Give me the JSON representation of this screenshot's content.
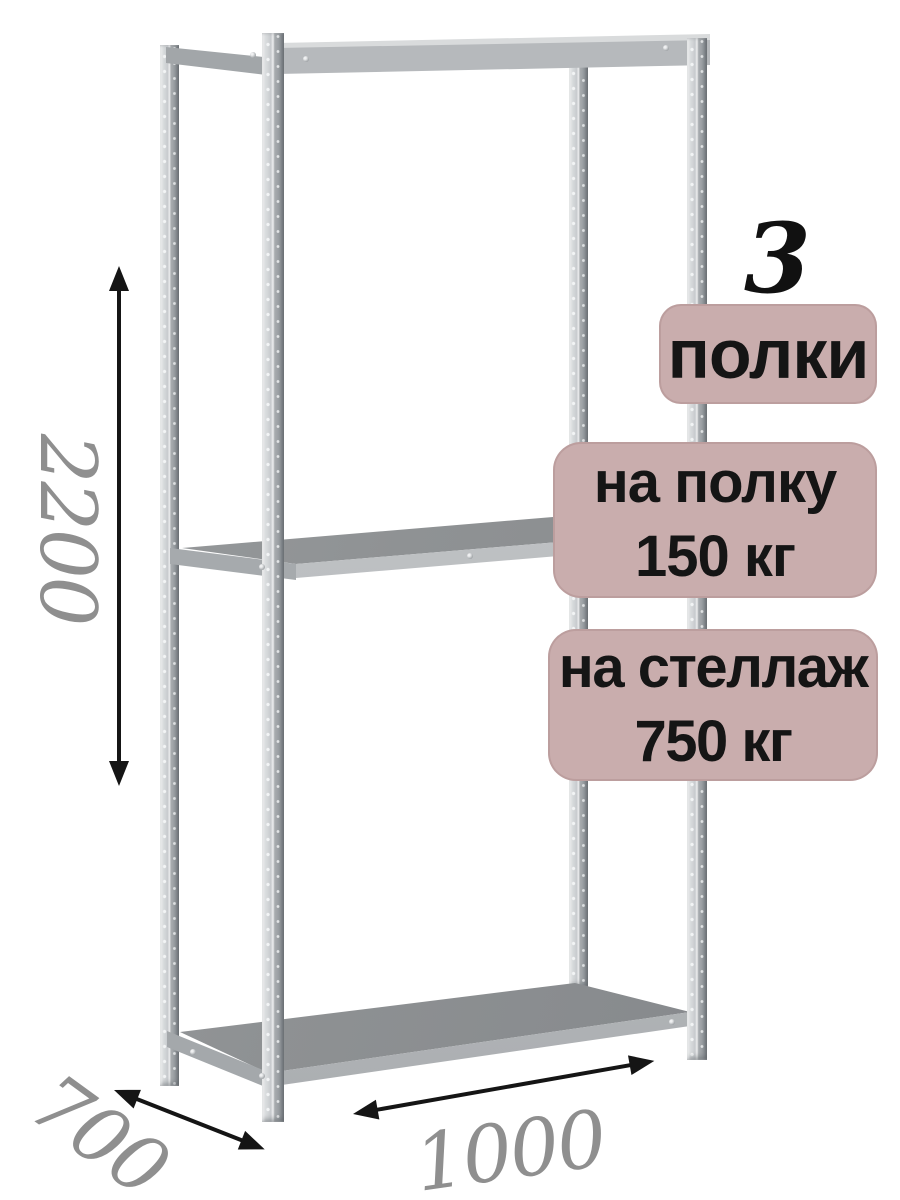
{
  "dimensions": {
    "height": "2200",
    "depth": "700",
    "width": "1000"
  },
  "callouts": {
    "shelf_count": "3",
    "shelf_count_unit": "полки",
    "shelf_load_line1": "на полку",
    "shelf_load_line2": "150 кг",
    "rack_load_line1": "на стеллаж",
    "rack_load_line2": "750 кг"
  },
  "colors": {
    "badge_bg": "#c9adad",
    "badge_text": "#151515",
    "dimension_text": "#8f8f8f",
    "arrow": "#151515",
    "shelf_surface": "#8f9294",
    "shelf_edge": "#bfc2c4",
    "background": "#ffffff"
  }
}
